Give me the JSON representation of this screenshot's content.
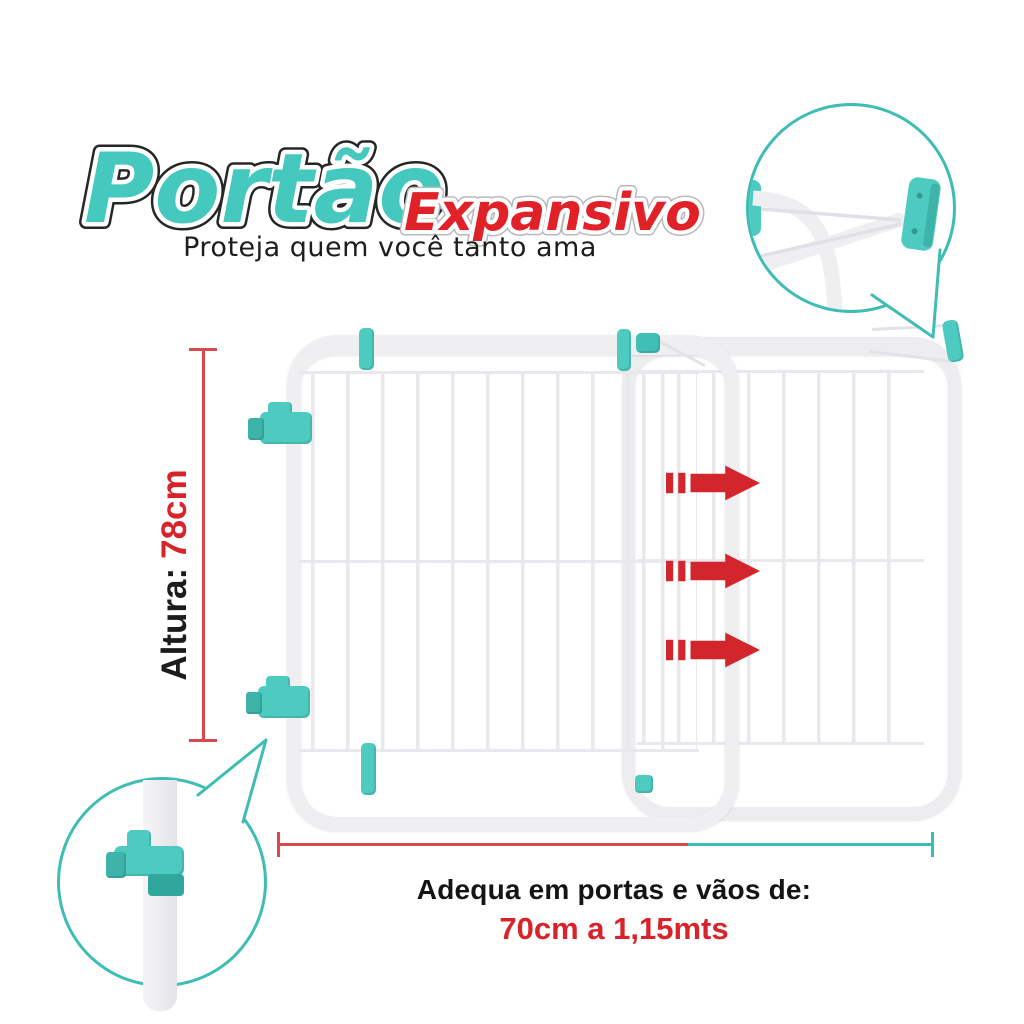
{
  "logo": {
    "title_primary": "Portão",
    "title_secondary": "Expansivo",
    "tagline": "Proteja quem você tanto ama",
    "title_primary_color": "#45C8BE",
    "title_secondary_color": "#E02128"
  },
  "gate": {
    "panel_count": 2,
    "frame_color": "#EFEFF1",
    "clip_color": "#4ECBC1",
    "expand_arrow_count": 3,
    "expand_arrow_color": "#D2262C",
    "expand_direction": "right"
  },
  "dimensions": {
    "height_label": "Altura:",
    "height_value": "78cm",
    "height_line_color": "#D8484E",
    "width_line_red_color": "#D8484E",
    "width_line_teal_color": "#3CBDB4"
  },
  "footer": {
    "line1": "Adequa em portas e vãos de:",
    "line2": "70cm a 1,15mts",
    "line2_color": "#D8232A"
  },
  "callouts": {
    "top_right": "wall-mount-detail",
    "bottom_left": "clamp-detail",
    "border_color": "#3FBDB5"
  }
}
